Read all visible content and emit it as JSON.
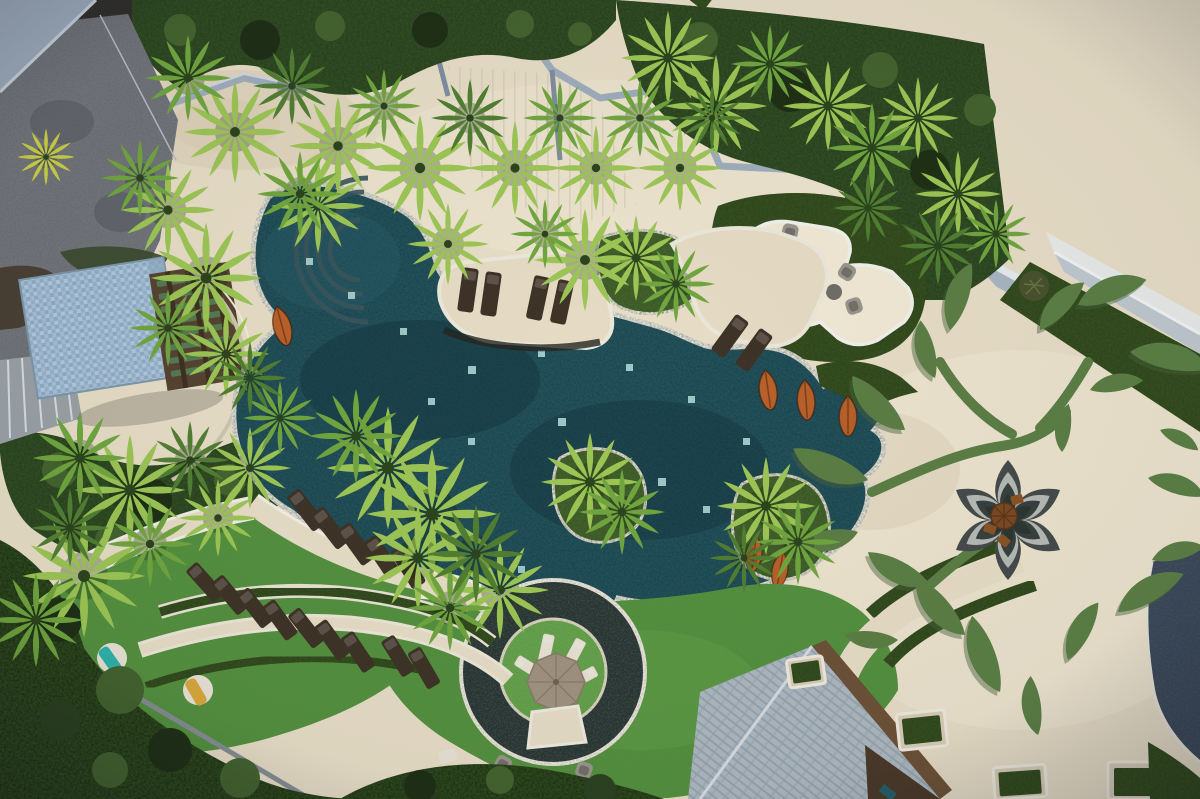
{
  "scene": {
    "type": "aerial-photograph",
    "subject": "Aerial top-down drone view of a tropical resort pool landscape at dusk",
    "areas": {
      "pool": "Large free-form dark teal lagoon pool with white coping, underwater light tiles, curved entry steps and planted islands",
      "islands": "Sand-colored lounger island and green palm islands inside the pool",
      "plaza": "Cream stone plaza with a giant green leaf-and-vine turf motif radiating from a lotus-shaped sunken seating pit",
      "building": "Modern resort wing with diagonal terraces, private plunge pools, turf strips and timber-slat pergola",
      "lawn_terraces": "Curved artificial-turf terraces with rows of timber sun loungers and two round daybeds",
      "ring_lounge": "Circular turf island ringed by dark stone water, with taupe umbrella and white loungers",
      "pavilion": "Blue mosaic-tiled roof pavilion with timber pergola and green louvres",
      "edges": "Grey access road top-left, dense jungle canopy strips, forest below the lawn deck, shingle roof bottom-centre"
    }
  },
  "inventory": {
    "palm_trees": 54,
    "sun_loungers": 30,
    "orange_urns": 6,
    "round_daybeds": 2,
    "umbrellas": 2,
    "plunge_pools": 3,
    "lounge_chairs": 8,
    "leaf_motif_leaves": 20,
    "lotus_petals": 6
  },
  "colors": {
    "paving": "#e8dec7",
    "paving_shadow": "#d6c9af",
    "paving_light": "#f1e9d5",
    "island_sand": "#e6dbc4",
    "pool_water": "#1d4952",
    "pool_water_deep": "#14323c",
    "pool_water_light": "#2b5f69",
    "pool_coping": "#ebe7da",
    "pool_stone_edge": "#26251f",
    "pool_light_tile": "#b7dedd",
    "pool_steps": "#3a565c",
    "lawn": "#55923f",
    "lawn_light": "#67a54d",
    "lawn_dark": "#47803a",
    "jungle": "#2c4220",
    "jungle_light": "#44642f",
    "jungle_dark": "#1f3016",
    "hedge": "#31461f",
    "forest": "#243619",
    "palm_bright": "#9dc655",
    "palm_mid": "#71a63f",
    "palm_dark": "#527f33",
    "palm_yellow": "#c9cf45",
    "leaf_motif": "#5c7f45",
    "leaf_shadow": "#48633b",
    "lotus_outer": "#45494a",
    "lotus_ring": "#b7bbb5",
    "lotus_inner": "#39413f",
    "lotus_core": "#2c3733",
    "lotus_parasol": "#7b4a24",
    "lounger_wood": "#3e3327",
    "lounger_gray": "#3f4440",
    "lounger_white": "#e9e3d5",
    "urn_orange": "#b8612a",
    "chair_gray": "#9a968c",
    "table_gray": "#6f6f68",
    "umbrella_taupe": "#a29380",
    "towel_teal": "#2fb3ab",
    "towel_yellow": "#d8a93c",
    "cushion_orange": "#c96a28",
    "road": "#73767a",
    "road_wet": "#585c62",
    "wall_bluegray": "#9fadbd",
    "roof_mosaic": "#a7c0d6",
    "pergola_wood": "#574432",
    "pergola_slat": "#567a52",
    "bld_white": "#e9ebea",
    "bld_rib": "#c0c9cf",
    "bld_glass": "#9db0bc",
    "bld_grass": "#5f9447",
    "bld_plunge": "#1e423c",
    "bld_stone": "#8f9798",
    "bld_wood": "#b5854c",
    "bld_glass_dark": "#275f68",
    "bld_window": "#1f4a48",
    "bld_column": "#d9a13f",
    "bld_wall": "#a9b6c2",
    "shingle": "#aeb9c1",
    "shingle_dark": "#98a5ae",
    "eave_wood": "#6d5238",
    "dark_wedge": "#3a4a5a",
    "deck_edge": "#868e93"
  }
}
